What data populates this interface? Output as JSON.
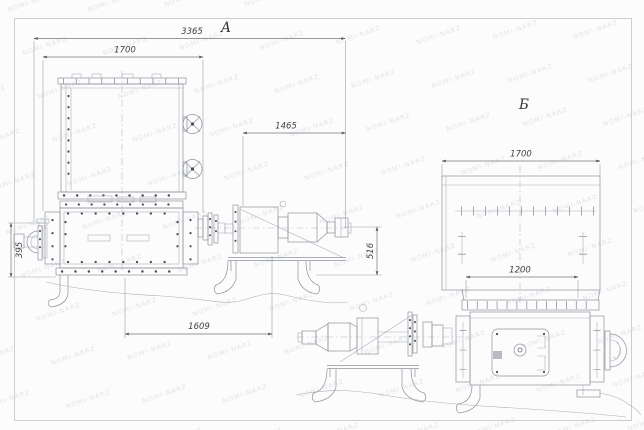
{
  "watermark": {
    "text": "NOMI-NARZ"
  },
  "views": {
    "a": {
      "label": "A",
      "dim_overall": "3365",
      "dim_hopper": "1700",
      "dim_drive": "1465",
      "dim_height": "516",
      "dim_base": "1609",
      "dim_inlet": "395"
    },
    "b": {
      "label": "Б",
      "dim_top": "1700",
      "dim_flange": "1200"
    }
  }
}
